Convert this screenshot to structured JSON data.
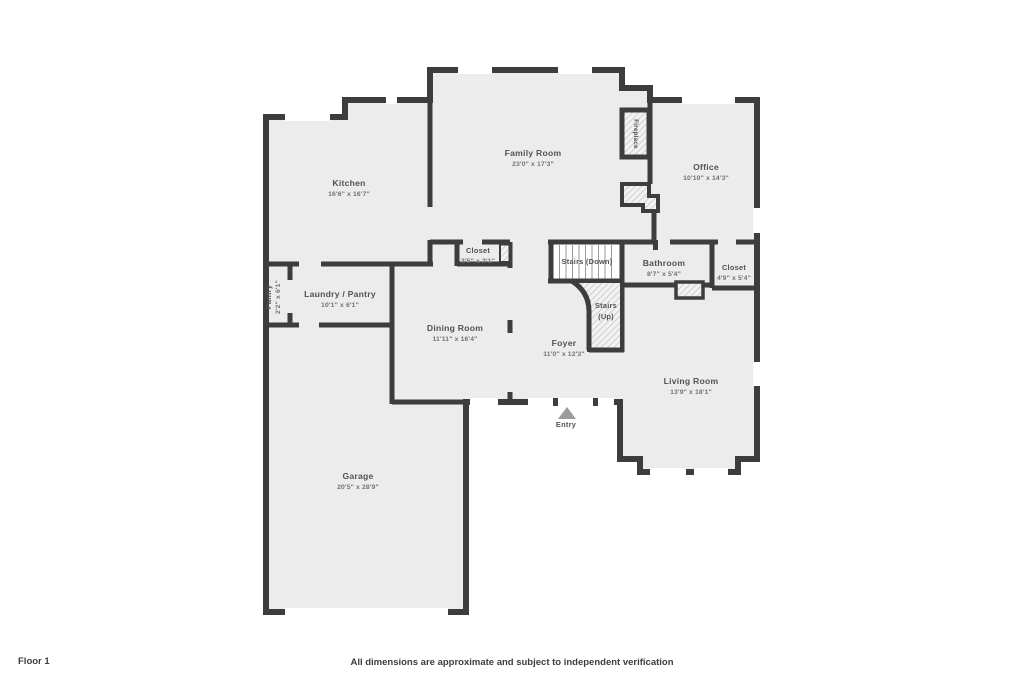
{
  "footer": {
    "floor_label": "Floor 1",
    "disclaimer": "All dimensions are approximate and subject to independent verification"
  },
  "floorplan": {
    "colors": {
      "floor": "#ececec",
      "wall": "#3d3d3d",
      "hatch_line": "#bcbcbc",
      "entry_arrow": "#9b9b9b"
    },
    "rooms": [
      {
        "id": "kitchen",
        "name": "Kitchen",
        "dims": "16'6\" x 16'7\"",
        "cx": 349,
        "cy": 186
      },
      {
        "id": "family-room",
        "name": "Family Room",
        "dims": "23'0\" x 17'3\"",
        "cx": 533,
        "cy": 156
      },
      {
        "id": "office",
        "name": "Office",
        "dims": "10'10\" x 14'3\"",
        "cx": 706,
        "cy": 170
      },
      {
        "id": "closet-a",
        "name": "Closet",
        "dims": "3'5\" x 2'1\"",
        "cx": 478,
        "cy": 253,
        "cls": "sm"
      },
      {
        "id": "stairs-down",
        "name": "Stairs (Down)",
        "cx": 587,
        "cy": 264,
        "cls": "sm"
      },
      {
        "id": "bathroom",
        "name": "Bathroom",
        "dims": "8'7\" x 5'4\"",
        "cx": 664,
        "cy": 266
      },
      {
        "id": "closet-b",
        "name": "Closet",
        "dims": "4'9\" x 5'4\"",
        "cx": 734,
        "cy": 270,
        "cls": "sm"
      },
      {
        "id": "laundry-pantry",
        "name": "Laundry / Pantry",
        "dims": "10'1\" x 6'1\"",
        "cx": 340,
        "cy": 297
      },
      {
        "id": "pantry",
        "name": "Pantry",
        "dims": "2'2\" x 6'1\"",
        "cx": 271,
        "cy": 297,
        "rotate": -90,
        "cls": "sm"
      },
      {
        "id": "dining-room",
        "name": "Dining Room",
        "dims": "11'11\" x 16'4\"",
        "cx": 455,
        "cy": 331
      },
      {
        "id": "foyer",
        "name": "Foyer",
        "dims": "11'0\" x 12'3\"",
        "cx": 564,
        "cy": 346
      },
      {
        "id": "stairs-up",
        "name": "Stairs",
        "name2": "(Up)",
        "cx": 606,
        "cy": 308,
        "cls": "sm"
      },
      {
        "id": "living-room",
        "name": "Living Room",
        "dims": "13'9\" x 18'1\"",
        "cx": 691,
        "cy": 384
      },
      {
        "id": "garage",
        "name": "Garage",
        "dims": "20'5\" x 28'9\"",
        "cx": 358,
        "cy": 479
      },
      {
        "id": "entry",
        "name": "Entry",
        "cx": 566,
        "cy": 427,
        "cls": "sm"
      },
      {
        "id": "fireplace",
        "name": "Fireplace",
        "cx": 634,
        "cy": 134,
        "rotate": 90,
        "cls": "xs"
      }
    ]
  }
}
